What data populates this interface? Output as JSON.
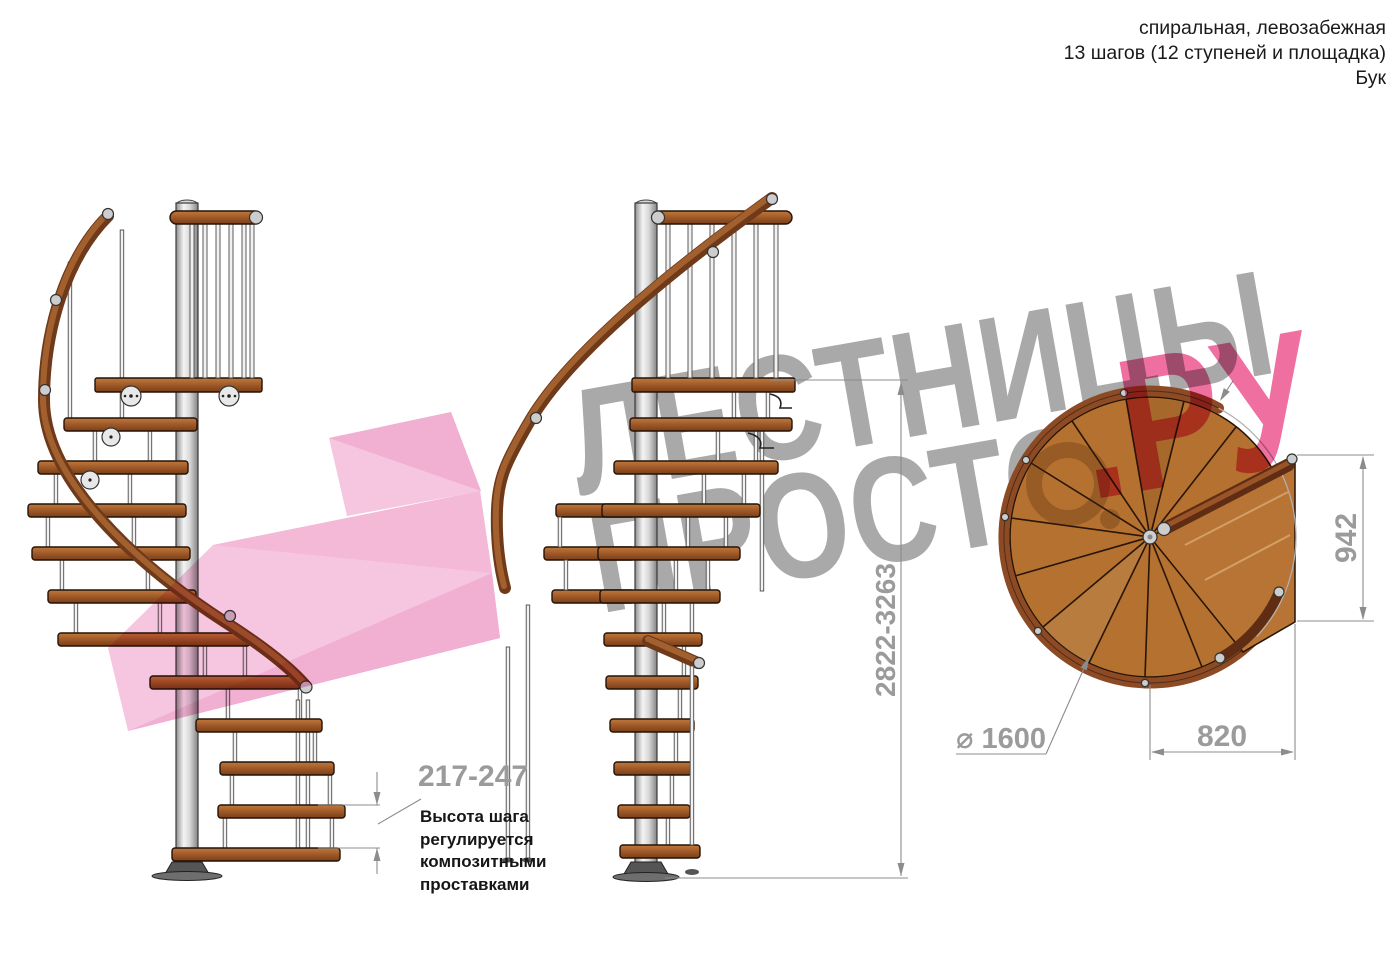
{
  "header": {
    "line1": "спиральная, левозабежная",
    "line2": "13 шагов (12 ступеней и площадка)",
    "line3": "Бук"
  },
  "watermark": {
    "word_top": "ЛЕСТНИЦЫ",
    "word_bottom": "ПРОСТО",
    "word_suffix": ".РУ"
  },
  "annotations": {
    "step_height": {
      "value": "217-247",
      "note_line1": "Высота шага",
      "note_line2": "регулируется",
      "note_line3": "композитными",
      "note_line4": "проставками"
    },
    "total_height": {
      "value": "2822-3263"
    },
    "landing_side": {
      "value": "942"
    },
    "diameter": {
      "value": "⌀ 1600"
    },
    "landing_width": {
      "value": "820"
    }
  },
  "colors": {
    "accent_pink": "#ee6fa0",
    "arrow_pink": "#f5bcdb",
    "watermark_gray": "#a9a9a9",
    "dimension_gray": "#8c8c8c",
    "wood": "#a05a2c",
    "wood_dark": "#6f3a1a",
    "pole_gray": "#d8d8d8",
    "ink": "#1a1a1a"
  }
}
